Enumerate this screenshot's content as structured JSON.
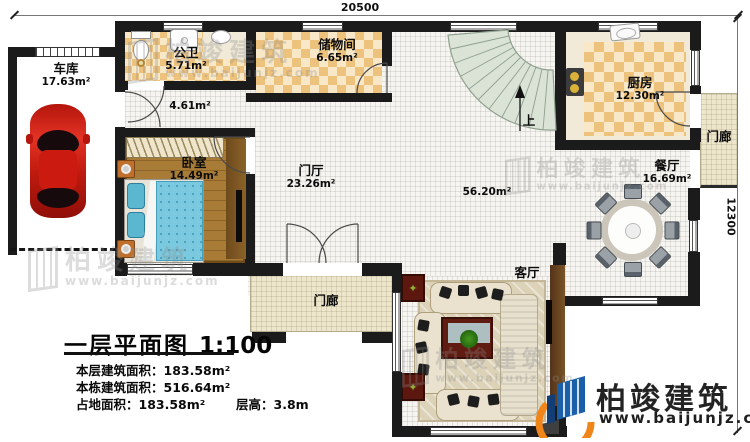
{
  "plan": {
    "sheet_title": "一层平面图",
    "scale": "1:100"
  },
  "dimensions": {
    "width_mm": "20500",
    "depth_mm": "12300"
  },
  "rooms": {
    "garage": {
      "name": "车库",
      "area": "17.63m²"
    },
    "bathroom": {
      "name": "公卫",
      "area": "5.71m²"
    },
    "storage": {
      "name": "储物间",
      "area": "6.65m²"
    },
    "hallway": {
      "area": "4.61m²"
    },
    "bedroom": {
      "name": "卧室",
      "area": "14.49m²"
    },
    "foyer": {
      "name": "门厅",
      "area": "23.26m²"
    },
    "kitchen": {
      "name": "厨房",
      "area": "12.30m²"
    },
    "dining": {
      "name": "餐厅",
      "area": "16.69m²"
    },
    "living": {
      "name": "客厅",
      "area": "56.20m²"
    },
    "porch_right": {
      "name": "门廊"
    },
    "porch_bottom": {
      "name": "门廊"
    }
  },
  "stairs": {
    "up_label": "上"
  },
  "title_block": {
    "title": "一层平面图",
    "scale": "1:100",
    "stats": [
      {
        "label": "本层建筑面积：",
        "value": "183.58m²"
      },
      {
        "label": "本栋建筑面积：",
        "value": "516.64m²"
      },
      {
        "label": "占地面积：",
        "value": "183.58m²"
      },
      {
        "label": "层高：",
        "value": "3.8m"
      }
    ]
  },
  "branding": {
    "company": "柏竣建筑",
    "website": "www.baijunjz.com"
  },
  "watermark": {
    "company": "柏竣建筑",
    "website": "www.baijunjz.com"
  },
  "icons": {
    "plant": "✦"
  },
  "colors": {
    "wall": "#1b1b1b",
    "tile_dark": "#ecc27c",
    "tile_light": "#f8e8c8",
    "wood": "#a87c36",
    "stair": "#dbe3d6",
    "porch": "#ede6cb",
    "car_red": "#cf1d12",
    "logo_blue": "#1a5fa8",
    "logo_orange": "#f08519"
  }
}
